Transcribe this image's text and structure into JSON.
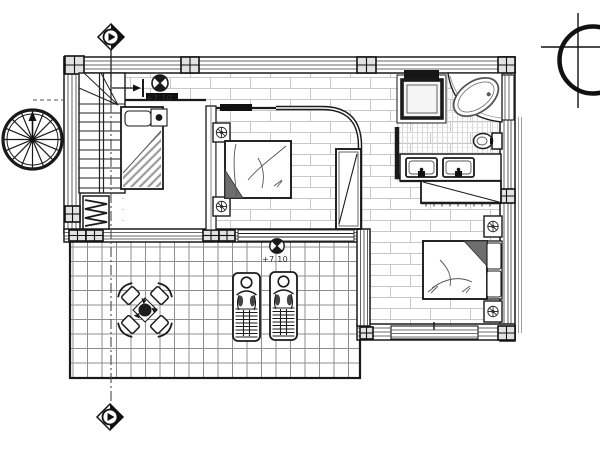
{
  "drawing": {
    "type": "architectural floor plan",
    "level_labels": {
      "interior": "+7.10",
      "terrace": "+7.10"
    }
  },
  "colors": {
    "background": "#ffffff",
    "line": "#1a1a1a",
    "furniture_shade": "#6e6e6e",
    "brick_joint": "#c8c8c8",
    "terrace_grid": "#8f8f8f",
    "bathroom_tile": "#d6d6d6"
  },
  "icons": [
    "north-arrow-icon",
    "section-marker-top-icon",
    "section-marker-bottom-icon",
    "level-marker-upper-icon",
    "level-marker-terrace-icon",
    "spiral-staircase-icon"
  ]
}
